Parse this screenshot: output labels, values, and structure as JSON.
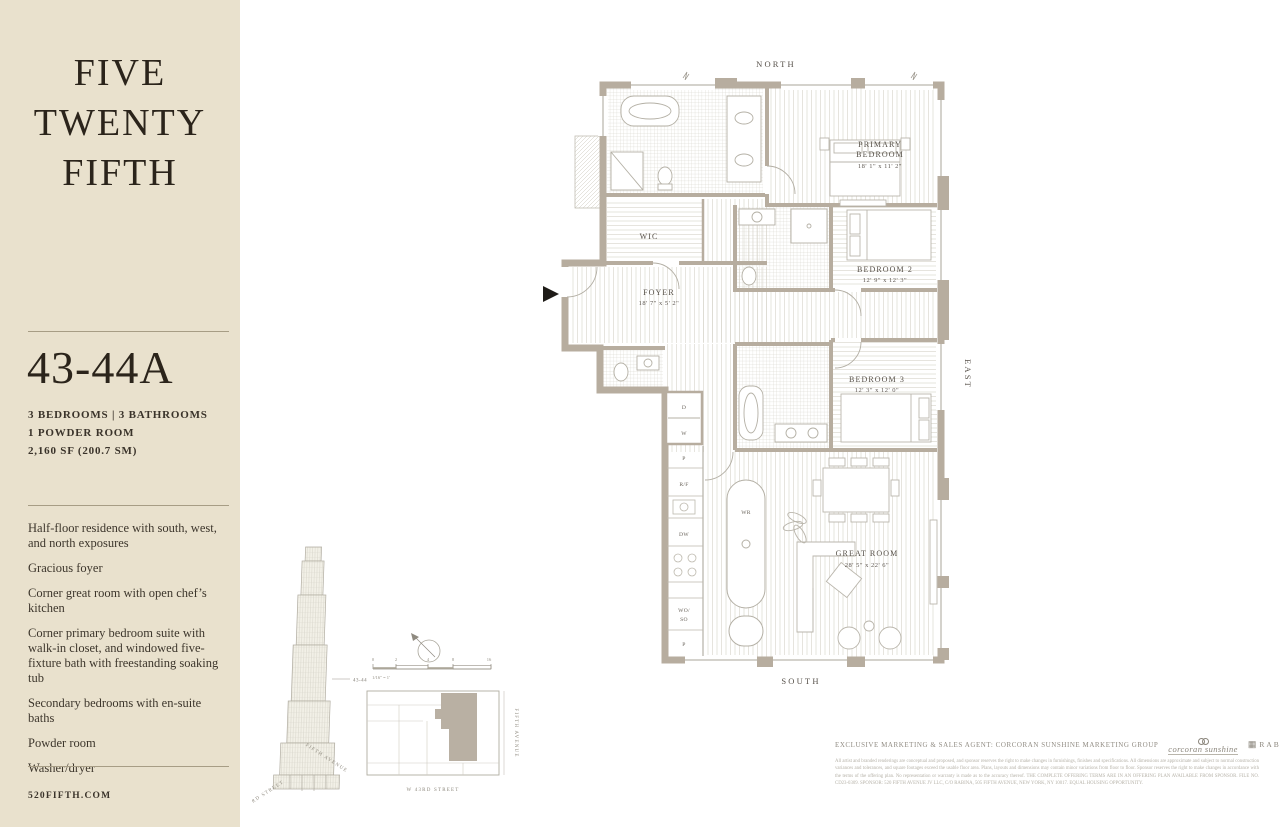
{
  "sidebar": {
    "brand": {
      "line1": "FIVE",
      "line2": "TWENTY",
      "line3": "FIFTH"
    },
    "unit": "43-44A",
    "specs": [
      "3 BEDROOMS | 3 BATHROOMS",
      "1 POWDER ROOM",
      "2,160 SF (200.7 SM)"
    ],
    "features": [
      "Half-floor residence with south, west, and north exposures",
      "Gracious foyer",
      "Corner great room with open chef’s kitchen",
      "Corner primary bedroom suite with walk-in closet, and windowed five-fixture bath with freestanding soaking tub",
      "Secondary bedrooms with en-suite baths",
      "Powder room",
      "Washer/dryer"
    ],
    "website": "520FIFTH.COM"
  },
  "floorplan": {
    "compass": {
      "north": "NORTH",
      "east": "EAST",
      "south": "SOUTH"
    },
    "rooms": {
      "primary": {
        "line1": "PRIMARY",
        "line2": "BEDROOM",
        "dims": "18' 1\" x 11' 2\""
      },
      "bedroom2": {
        "name": "BEDROOM 2",
        "dims": "12' 9\" x 12' 3\""
      },
      "bedroom3": {
        "name": "BEDROOM 3",
        "dims": "12' 3\" x 12' 0\""
      },
      "great_room": {
        "name": "GREAT ROOM",
        "dims": "28' 5\" x 22' 6\""
      },
      "foyer": {
        "name": "FOYER",
        "dims": "18' 7\" x 5' 2\""
      },
      "wic": "WIC"
    },
    "appliances": {
      "dryer": "D",
      "washer": "W",
      "pantry_top": "P",
      "fridge": "R/F",
      "dishwasher": "DW",
      "wall_oven": "WO/",
      "speed_oven": "SO",
      "pantry_bottom": "P",
      "wine_fridge": "WR"
    }
  },
  "locator": {
    "floor_marker": "43-44",
    "tower_streets": {
      "left": "W 43RD STREET",
      "right": "FIFTH AVENUE"
    },
    "scale": {
      "ticks": [
        "0",
        "2",
        "4",
        "8",
        "16"
      ],
      "note": "1/16\" = 1'"
    },
    "keyplan": {
      "street_bottom": "W 43RD STREET",
      "street_right": "FIFTH AVENUE"
    }
  },
  "footer": {
    "agent_line": "EXCLUSIVE MARKETING & SALES AGENT: CORCORAN SUNSHINE MARKETING GROUP",
    "logos": {
      "corcoran": "corcoran sunshine",
      "rabina": "RABINA"
    },
    "legal": "All artist and branded renderings are conceptual and proposed, and sponsor reserves the right to make changes in furnishings, finishes and specifications. All dimensions are approximate and subject to normal construction variances and tolerances, and square footages exceed the usable floor area. Plans, layouts and dimensions may contain minor variations from floor to floor. Sponsor reserves the right to make changes in accordance with the terms of the offering plan. No representation or warranty is made as to the accuracy thereof. THE COMPLETE OFFERING TERMS ARE IN AN OFFERING PLAN AVAILABLE FROM SPONSOR. FILE NO. CD23-0309. SPONSOR: 520 FIFTH AVENUE JV LLC, C/O RABINA, 505 FIFTH AVENUE, NEW YORK, NY 10017. EQUAL HOUSING OPPORTUNITY."
  }
}
